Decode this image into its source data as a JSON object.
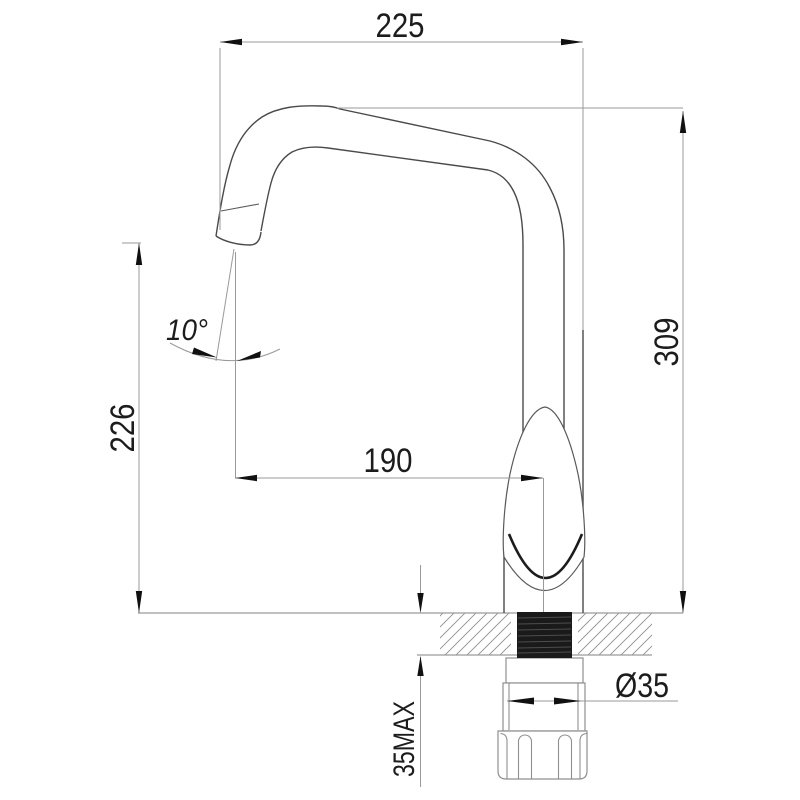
{
  "drawing": {
    "type": "technical-dimension-drawing",
    "subject": "kitchen-faucet-side-view",
    "background": "#ffffff",
    "line_color": "#4a4a4a",
    "dim_color": "#9a9a9a",
    "text_color": "#1c1c1c",
    "dimensions": {
      "spout_reach_overall": "225",
      "overall_height": "309",
      "spout_outlet_height": "226",
      "outlet_to_body_center": "190",
      "outlet_angle": "10°",
      "base_diameter": "Ø35",
      "deck_thickness_max": "35MAX"
    }
  }
}
